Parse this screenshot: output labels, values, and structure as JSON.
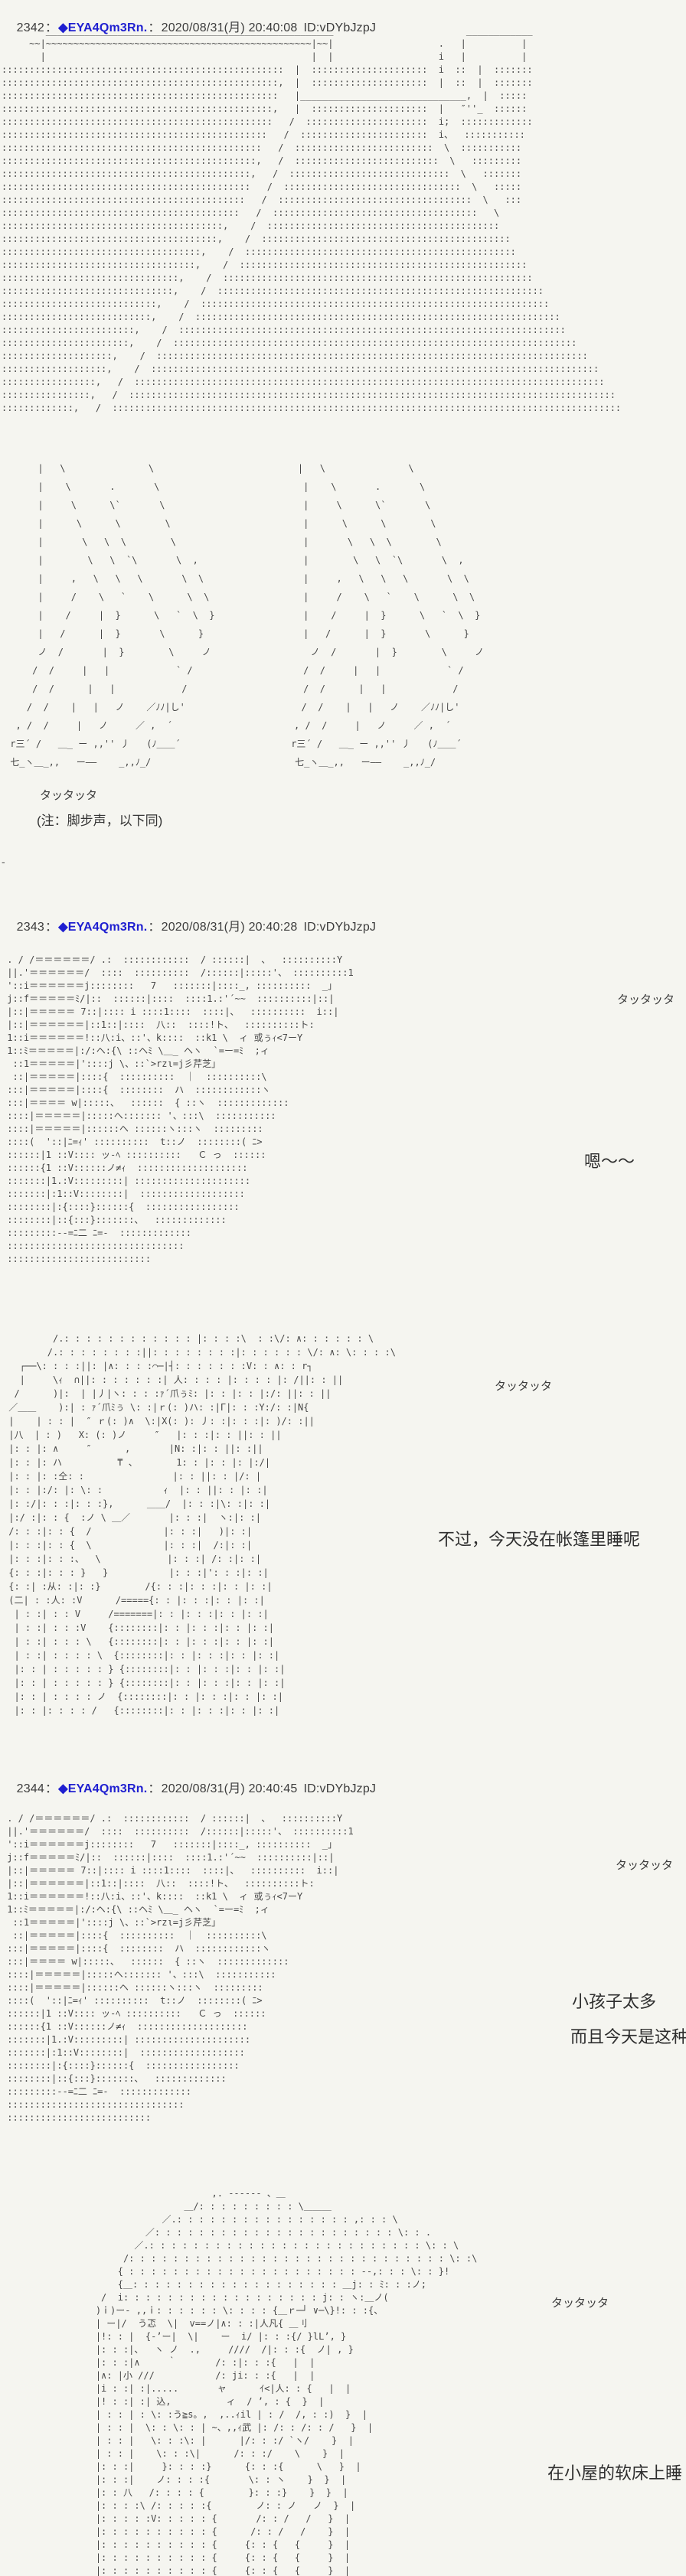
{
  "page": {
    "background": "#f5f5f0",
    "text_color": "#3a3a3a",
    "tripcode_color": "#1f1fd0",
    "aa_color": "#474747"
  },
  "sep": "：",
  "posts": [
    {
      "number": "2342",
      "tripcode": "◆EYA4Qm3Rn.",
      "datetime": "2020/08/31(月) 20:40:08",
      "id": "ID:vDYbJzpJ"
    },
    {
      "number": "2343",
      "tripcode": "◆EYA4Qm3Rn.",
      "datetime": "2020/08/31(月) 20:40:28",
      "id": "ID:vDYbJzpJ"
    },
    {
      "number": "2344",
      "tripcode": "◆EYA4Qm3Rn.",
      "datetime": "2020/08/31(月) 20:40:45",
      "id": "ID:vDYbJzpJ"
    }
  ],
  "texts": {
    "sfx": "タッタッタ",
    "note": "(注：脚步声，以下同)",
    "dash": "-",
    "hum": "嗯～～",
    "speech_tent": "不过，今天没在帐篷里睡呢",
    "speech_kids_1": "小孩子太多",
    "speech_kids_2": "而且今天是这种",
    "speech_bed": "在小屋的软床上睡"
  },
  "aa": {
    "scene": [
      "        ____________________________________________________                        ____________",
      "     ~~|~~~~~~~~~~~~~~~~~~~~~~~~~~~~~~~~~~~~~~~~~~~~~~~~|~~|                   .   |          |",
      "       |                                                |  |                   i   |          |",
      ":::::::::::::::::::::::::::::::::::::::::::::::::::  |  :::::::::::::::::::::  i  ::  |  :::::::",
      "::::::::::::::::::::::::::::::::::::::::::::::::::,  |  :::::::::::::::::::::  |  ::  |  :::::::",
      "::::::::::::::::::::::::::::::::::::::::::::::::::   |______________________________,  |  :::::",
      ":::::::::::::::::::::::::::::::::::::::::::::::::,   |  :::::::::::::::::::::  |   ″''_  ::::::",
      ":::::::::::::::::::::::::::::::::::::::::::::::::   /  ::::::::::::::::::::::  i;  :::::::::::::",
      "::::::::::::::::::::::::::::::::::::::::::::::::   /  :::::::::::::::::::::::  i、  :::::::::::",
      ":::::::::::::::::::::::::::::::::::::::::::::::   /  :::::::::::::::::::::::::  \\  :::::::::::",
      "::::::::::::::::::::::::::::::::::::::::::::::,   /  ::::::::::::::::::::::::::  \\   :::::::::",
      ":::::::::::::::::::::::::::::::::::::::::::::,   /  :::::::::::::::::::::::::::::  \\   :::::::",
      ":::::::::::::::::::::::::::::::::::::::::::::   /  ::::::::::::::::::::::::::::::::  \\   :::::",
      "::::::::::::::::::::::::::::::::::::::::::::   /  :::::::::::::::::::::::::::::::::::  \\   :::",
      ":::::::::::::::::::::::::::::::::::::::::::   /  :::::::::::::::::::::::::::::::::::::   \\",
      "::::::::::::::::::::::::::::::::::::::::,    /  ::::::::::::::::::::::::::::::::::::::::::",
      ":::::::::::::::::::::::::::::::::::::::,    /  :::::::::::::::::::::::::::::::::::::::::::::",
      "::::::::::::::::::::::::::::::::::::,    /  :::::::::::::::::::::::::::::::::::::::::::::::::",
      ":::::::::::::::::::::::::::::::::::,    /  ::::::::::::::::::::::::::::::::::::::::::::::::::::",
      "::::::::::::::::::::::::::::::::,    /  ::::::::::::::::::::::::::::::::::::::::::::::::::::::::",
      ":::::::::::::::::::::::::::::::,    /  :::::::::::::::::::::::::::::::::::::::::::::::::::::::::::",
      "::::::::::::::::::::::::::::,    /  :::::::::::::::::::::::::::::::::::::::::::::::::::::::::::::::",
      ":::::::::::::::::::::::::::,    /  ::::::::::::::::::::::::::::::::::::::::::::::::::::::::::::::::::",
      "::::::::::::::::::::::::,    /  ::::::::::::::::::::::::::::::::::::::::::::::::::::::::::::::::::::::",
      ":::::::::::::::::::::::,    /  :::::::::::::::::::::::::::::::::::::::::::::::::::::::::::::::::::::::::",
      "::::::::::::::::::::,    /  ::::::::::::::::::::::::::::::::::::::::::::::::::::::::::::::::::::::::::::::",
      ":::::::::::::::::::,    /  :::::::::::::::::::::::::::::::::::::::::::::::::::::::::::::::::::::::::::::::::",
      ":::::::::::::::::,   /  :::::::::::::::::::::::::::::::::::::::::::::::::::::::::::::::::::::::::::::::::::::",
      "::::::::::::::::,   /  ::::::::::::::::::::::::::::::::::::::::::::::::::::::::::::::::::::::::::::::::::::::::",
      ":::::::::::::,   /  ::::::::::::::::::::::::::::::::::::::::::::::::::::::::::::::::::::::::::::::::::::::::::::"
    ],
    "legs": [
      "      |   \\               \\                          |   \\               \\",
      "      |    \\       .       \\                          |    \\       .       \\",
      "      |     \\      \\`       \\                         |     \\      \\`       \\",
      "      |      \\      \\        \\                        |      \\      \\        \\",
      "      |       \\   \\  \\        \\                       |       \\   \\  \\        \\",
      "      |        \\   \\  `\\       \\  ,                   |        \\   \\  `\\       \\  ,",
      "      |     ,   \\   \\   \\       \\  \\                  |     ,   \\   \\   \\       \\  \\",
      "      |     /    \\   `    \\      \\  \\                 |     /    \\   `    \\      \\  \\",
      "      |    /     |  }      \\   `  \\  }                |    /     |  }      \\   `  \\  }",
      "      |   /      |  }       \\      }                  |   /      |  }       \\      }",
      "      ノ  /       |  }        \\     ノ                  ノ  /       |  }        \\     ノ",
      "     /  /     |   |            ` /                    /  /     |   |            ` /",
      "     /  /      |   |            /                     /  /      |   |            /",
      "    /  /    |   |   ノ    ／ﾉﾉ|し'                     /  /    |   |   ノ    ／ﾉﾉ|し'",
      "  , /  /     |   ノ     ／ ,  ´                      , /  /     |   ノ     ／ ,  ´",
      " r三´ /   ＿_ ー ,,'' 丿   (ﾉ＿＿´                    r三´ /   ＿_ ー ,,'' 丿   (ﾉ＿＿´",
      " 七_ヽ＿_,,   ー――    _,,ﾉ_/                          七_ヽ＿_,,   ー――    _,,ﾉ_/"
    ],
    "camp": [
      " . / /＝＝＝＝＝＝/ .:  ::::::::::::  / ::::::|  、  ::::::::::Y",
      " ||.'＝＝＝＝＝＝/  ::::  ::::::::::  /::::::|:::::'、 ::::::::::1",
      " '::i＝＝＝＝＝＝j::::::::   7   :::::::|::::_, ::::::::::  _｣",
      " j::f＝＝＝＝＝ﾐ/|::  ::::::|::::  ::::1.:'´~~  ::::::::::|::|",
      " |::|＝＝＝＝＝ 7::|:::: i ::::1::::  ::::|、  ::::::::::  i::|",
      " |::|＝＝＝＝＝＝|::1::|::::  八::  ::::!ト、  ::::::::::ト:",
      " 1::i＝＝＝＝＝＝!::八:i、::'、k::::  ::k1 \\  ィ 或ぅｨ<7ーY",
      " 1::ﾐ＝＝＝＝＝|:/:ヘ:{\\ ::ヘﾐ \\＿_ ヘヽ  `=ー=ﾐ  ;ィ",
      "  ::1＝＝＝＝＝|'::::j \\、::`>rzι=j彡芹芝｣",
      "  ::|＝＝＝＝＝|::::{  ::::::::::  ｜  ::::::::::\\",
      " :::|＝＝＝＝＝|::::{  ::::::::  ハ  ::::::::::::ヽ",
      " :::|＝＝＝＝ w|:::::、  ::::::  { ::ヽ  :::::::::::::",
      " ::::|＝＝＝＝＝|:::::ヘ::::::: '、:::\\  :::::::::::",
      " ::::|＝＝＝＝＝|::::::ヘ ::::::ヽ:::ヽ  :::::::::",
      " ::::(  '::|ﾆ=ｨ' ::::::::::  t::ノ  ::::::::( ﾆ>",
      " ::::::|1 ::V:::: ッ-ﾍ ::::::::::   Ｃ っ  ::::::",
      " ::::::{1 ::V::::::ノ≠ｨ  ::::::::::::::::::::",
      " :::::::|1.:V:::::::::| :::::::::::::::::::::",
      " :::::::|:1::V::::::::|  :::::::::::::::::::",
      " ::::::::|:{::::}::::::{  :::::::::::::::::",
      " ::::::::|::{:::}:::::::、  :::::::::::::",
      " :::::::::--=ﾆ二 ﾆ=-  :::::::::::::",
      " ::::::::::::::::::::::::::::::::",
      " ::::::::::::::::::::::::::"
    ],
    "garden": [
      "         /.: : : : : : : : : : : : |: : : :\\  : :\\/: ∧: : : : : : \\",
      "        /.: : : : : : : :||: : : : : : : :|: : : : : : \\/: ∧: \\: : : :\\",
      "   ┌──\\: : : :||: |∧: : : :⌒─|┤: : : : : : :V: : ∧: : r┐",
      "   |     \\ｨ  ∩||: : : : : : :| 人: : : : |: : : : |: /||: : ||",
      "  /      )|:  | |丿|ヽ: : : :ｧ´爪ぅﾐ: |: : |: : |:/: ||: : ||",
      " ／＿＿    ):| : ｧ´爪ﾐぅ \\: :|ｒ(: )ハ: :|Γ|: : :Y:/: :|Ν{",
      " |    | : : |  ″ ｒ(: )∧  \\:|X(: ): 丿: :|: : :|: )/: :||",
      " |八  | : )   X: (: )ノ     ″   |: : :|: : ||: : ||",
      " |: : |: ∧     ″      ,       |Ν: :|: : ||: :||",
      " |: : |: ハ          ₸ 、       1: : |: : |: |:/|",
      " |: : |: :仝: :                |: : ||: : |/: |",
      " |: : |:/: |: \\: :           ｨ  |: : ||: : |: :|",
      " |: :/|: : :|: : :},      ＿＿/  |: : :|\\: :|: :|",
      " |:/ :|: : {  :ノ \\ ＿／       |: : :|  ヽ:|: :|",
      " /: : :|: : {  /             |: : :|   )|: :|",
      " |: : :|: : {  \\             |: : :|  /:|: :|",
      " |: : :|: : :、  \\            |: : :| /: :|: :|",
      " {: : :|: : : }   }           |: : :|': : :|: :|",
      " {: :| :从: :|: :}        /{: : :|: : :|: : |: :|",
      " (二| : :人: :V      /====={: : |: : :|: : |: :|",
      "  | : :| : : V     /=======|: : |: : :|: : |: :|",
      "  | : :| : : :V    {::::::::|: : |: : :|: : |: :|",
      "  | : :| : : : \\   {::::::::|: : |: : :|: : |: :|",
      "  | : :| : : : : \\  {::::::::|: : |: : :|: : |: :|",
      "  |: : | : : : : : } {::::::::|: : |: : :|: : |: :|",
      "  |: : | : : : : : } {::::::::|: : |: : :|: : |: :|",
      "  |: : | : : : : ノ  {::::::::|: : |: : :|: : |: :|",
      "  |: : |: : : : /   {::::::::|: : |: : :|: : |: :|"
    ],
    "figure": [
      "                                      ,. -‐‐‐‐- 、＿",
      "                                 ＿/: : : : : : : : : \\＿＿＿",
      "                             ／.: : : : : : : : : : : : : : : : ,: : : \\",
      "                          ／: : : : : : : : : : : : : : : : : : : : : : \\: : .",
      "                        ／.: : : : : : : : : : : : : : : : : : : : : : : : : \\: : \\",
      "                      /: : : : : : : : : : : : : : : : : : : : : : : : : : : : : \\: :\\",
      "                     { : : : : : : : : : : : : : : : : : : : : : --,: : : \\: : }!",
      "                     {＿: : : : : : : : : : : : : : : : : : : ＿j: : ﾐ: : :ノ;",
      "                  /  i: : : : : : : : : : : : : : : : : : j: : ヽ:＿ノ(",
      "                 )ｉ)ー‐ ,,ｉ: : : : : : \\: : : : {＿ｒ─┘ ∨─\\}!: : :{、",
      "                 | ー|/  う忑  \\|  v==ノ|∧: : :|人凡{ ＿刂",
      "                 |!: : |  {‐’ー|  \\|    ー  i/ |: : :{/ }lL’, }",
      "                 |: : :|、  ヽ ノ  .,     ////  /|: : :{  ノ| , }",
      "                 |: : :|∧     ｀       /: :|: : :{   |  |",
      "                 |∧: |小 ///           /: ji: : :{   |  |",
      "                 |i : :| :|.....       ャ      ｲ<|人: : {   |  |",
      "                 |! : :| :| 込,          ィ  / ’, : {  }  |",
      "                 | : : | : \\: :う≧s。,  ,..ｨil | : /  /, : :)  }  |",
      "                 | : : |  \\: : \\: : | ~、,,ｨ武 |: /: : /: : /   }  |",
      "                 | : : |   \\: : :\\: |      |/: : :/ `ヽ/    }  |",
      "                 | : : |    \\: : :\\|      /: : :/    \\    }  |",
      "                 |: : :|     }: : : :}      {: : :{      \\   }  |",
      "                 |: : :|    ノ: : : :{       \\: : ヽ    }  }  |",
      "                 |: : 八   /: : : : {        }: : :}    }  }  |",
      "                 |: : : :\\ /: : : : :{        ノ: : ノ   ノ  }  |",
      "                 |: : : : :V: : : : : {       /: : /   /   }  |",
      "                 |: : : : : : : : : : {      /: : /   /    }  |",
      "                 |: : : : : : : : : : {     {: : {   {     }  |",
      "                 |: : : : : : : : : : {     {: : {   {     }  |",
      "                 |: : : : : : : : : : {     {: : {   {     }  |"
    ]
  }
}
